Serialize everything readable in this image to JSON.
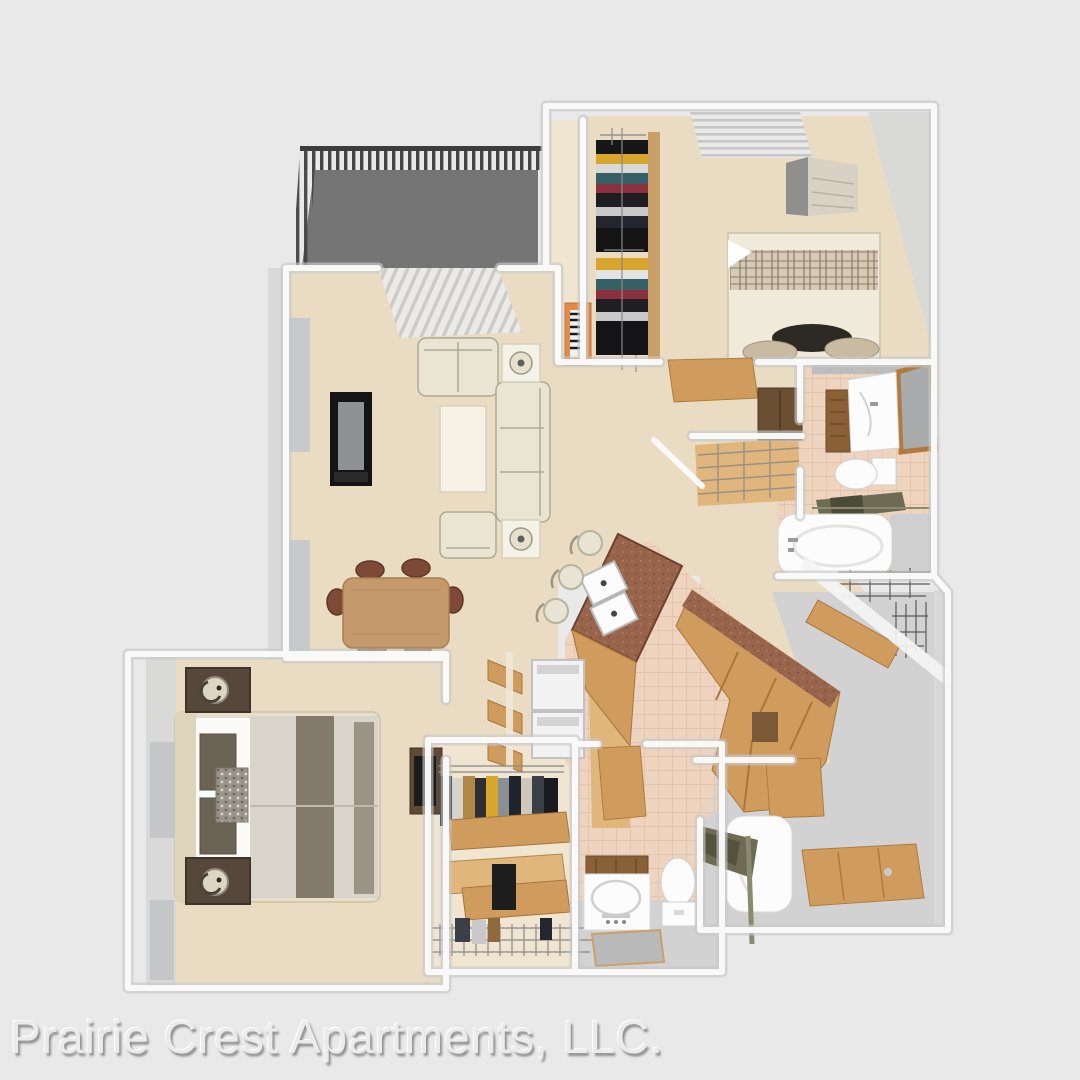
{
  "caption": {
    "text": "Prairie Crest Apartments, LLC."
  },
  "scene": {
    "type": "3d_rendered_floor_plan",
    "rooms": [
      "balcony",
      "living-room",
      "dining-area",
      "kitchen",
      "hallway",
      "bedroom-2",
      "bathroom-1",
      "master-bedroom",
      "walk-in-closet",
      "bathroom-2",
      "tub-room",
      "entry"
    ],
    "items": [
      "balcony-railing",
      "patio-vertical-blinds",
      "tv-console",
      "loveseat",
      "sofa",
      "armchair",
      "coffee-table",
      "end-table-lamp",
      "dining-table",
      "dining-chairs",
      "kitchen-island-sink",
      "bar-stools",
      "washer-dryer",
      "kitchen-cabinets",
      "bed",
      "plaid-bed",
      "dresser",
      "nightstand-lamps",
      "closet-clothes",
      "orange-bookcase",
      "vanity-sink",
      "mirror",
      "toilet",
      "bathtub",
      "towel-rack",
      "open-door-panels",
      "wire-shelving"
    ]
  },
  "palette": {
    "bg": "#e9e9e9",
    "caption": "#ebebeb",
    "caption_shadow": "#8f8f8f",
    "floor_beige": "#e9dcc3",
    "floor_beige_light": "#efe5d1",
    "tile_pink": "#eed3bf",
    "tile_grout": "#dfbfa9",
    "floor_gray": "#d2d2d3",
    "balcony_floor": "#757575",
    "railing": "#454545",
    "wall_face": "#d8d8d8",
    "wood": "#d09c5e",
    "wood_light": "#e0b67c",
    "wood_dark": "#8a6136",
    "counter": "#98644b",
    "cream": "#e9e5d2",
    "white_fixture": "#fcfcfc",
    "tv_black": "#141414",
    "nightstand": "#55483a",
    "quilt": "#d8d4c9",
    "quilt_stripe": "#837a6c",
    "pillow_dark": "#2d2a24",
    "pillow_tan": "#c9baa2",
    "towel": "#6d6c52",
    "orange_shelf": "#e18b4b"
  }
}
